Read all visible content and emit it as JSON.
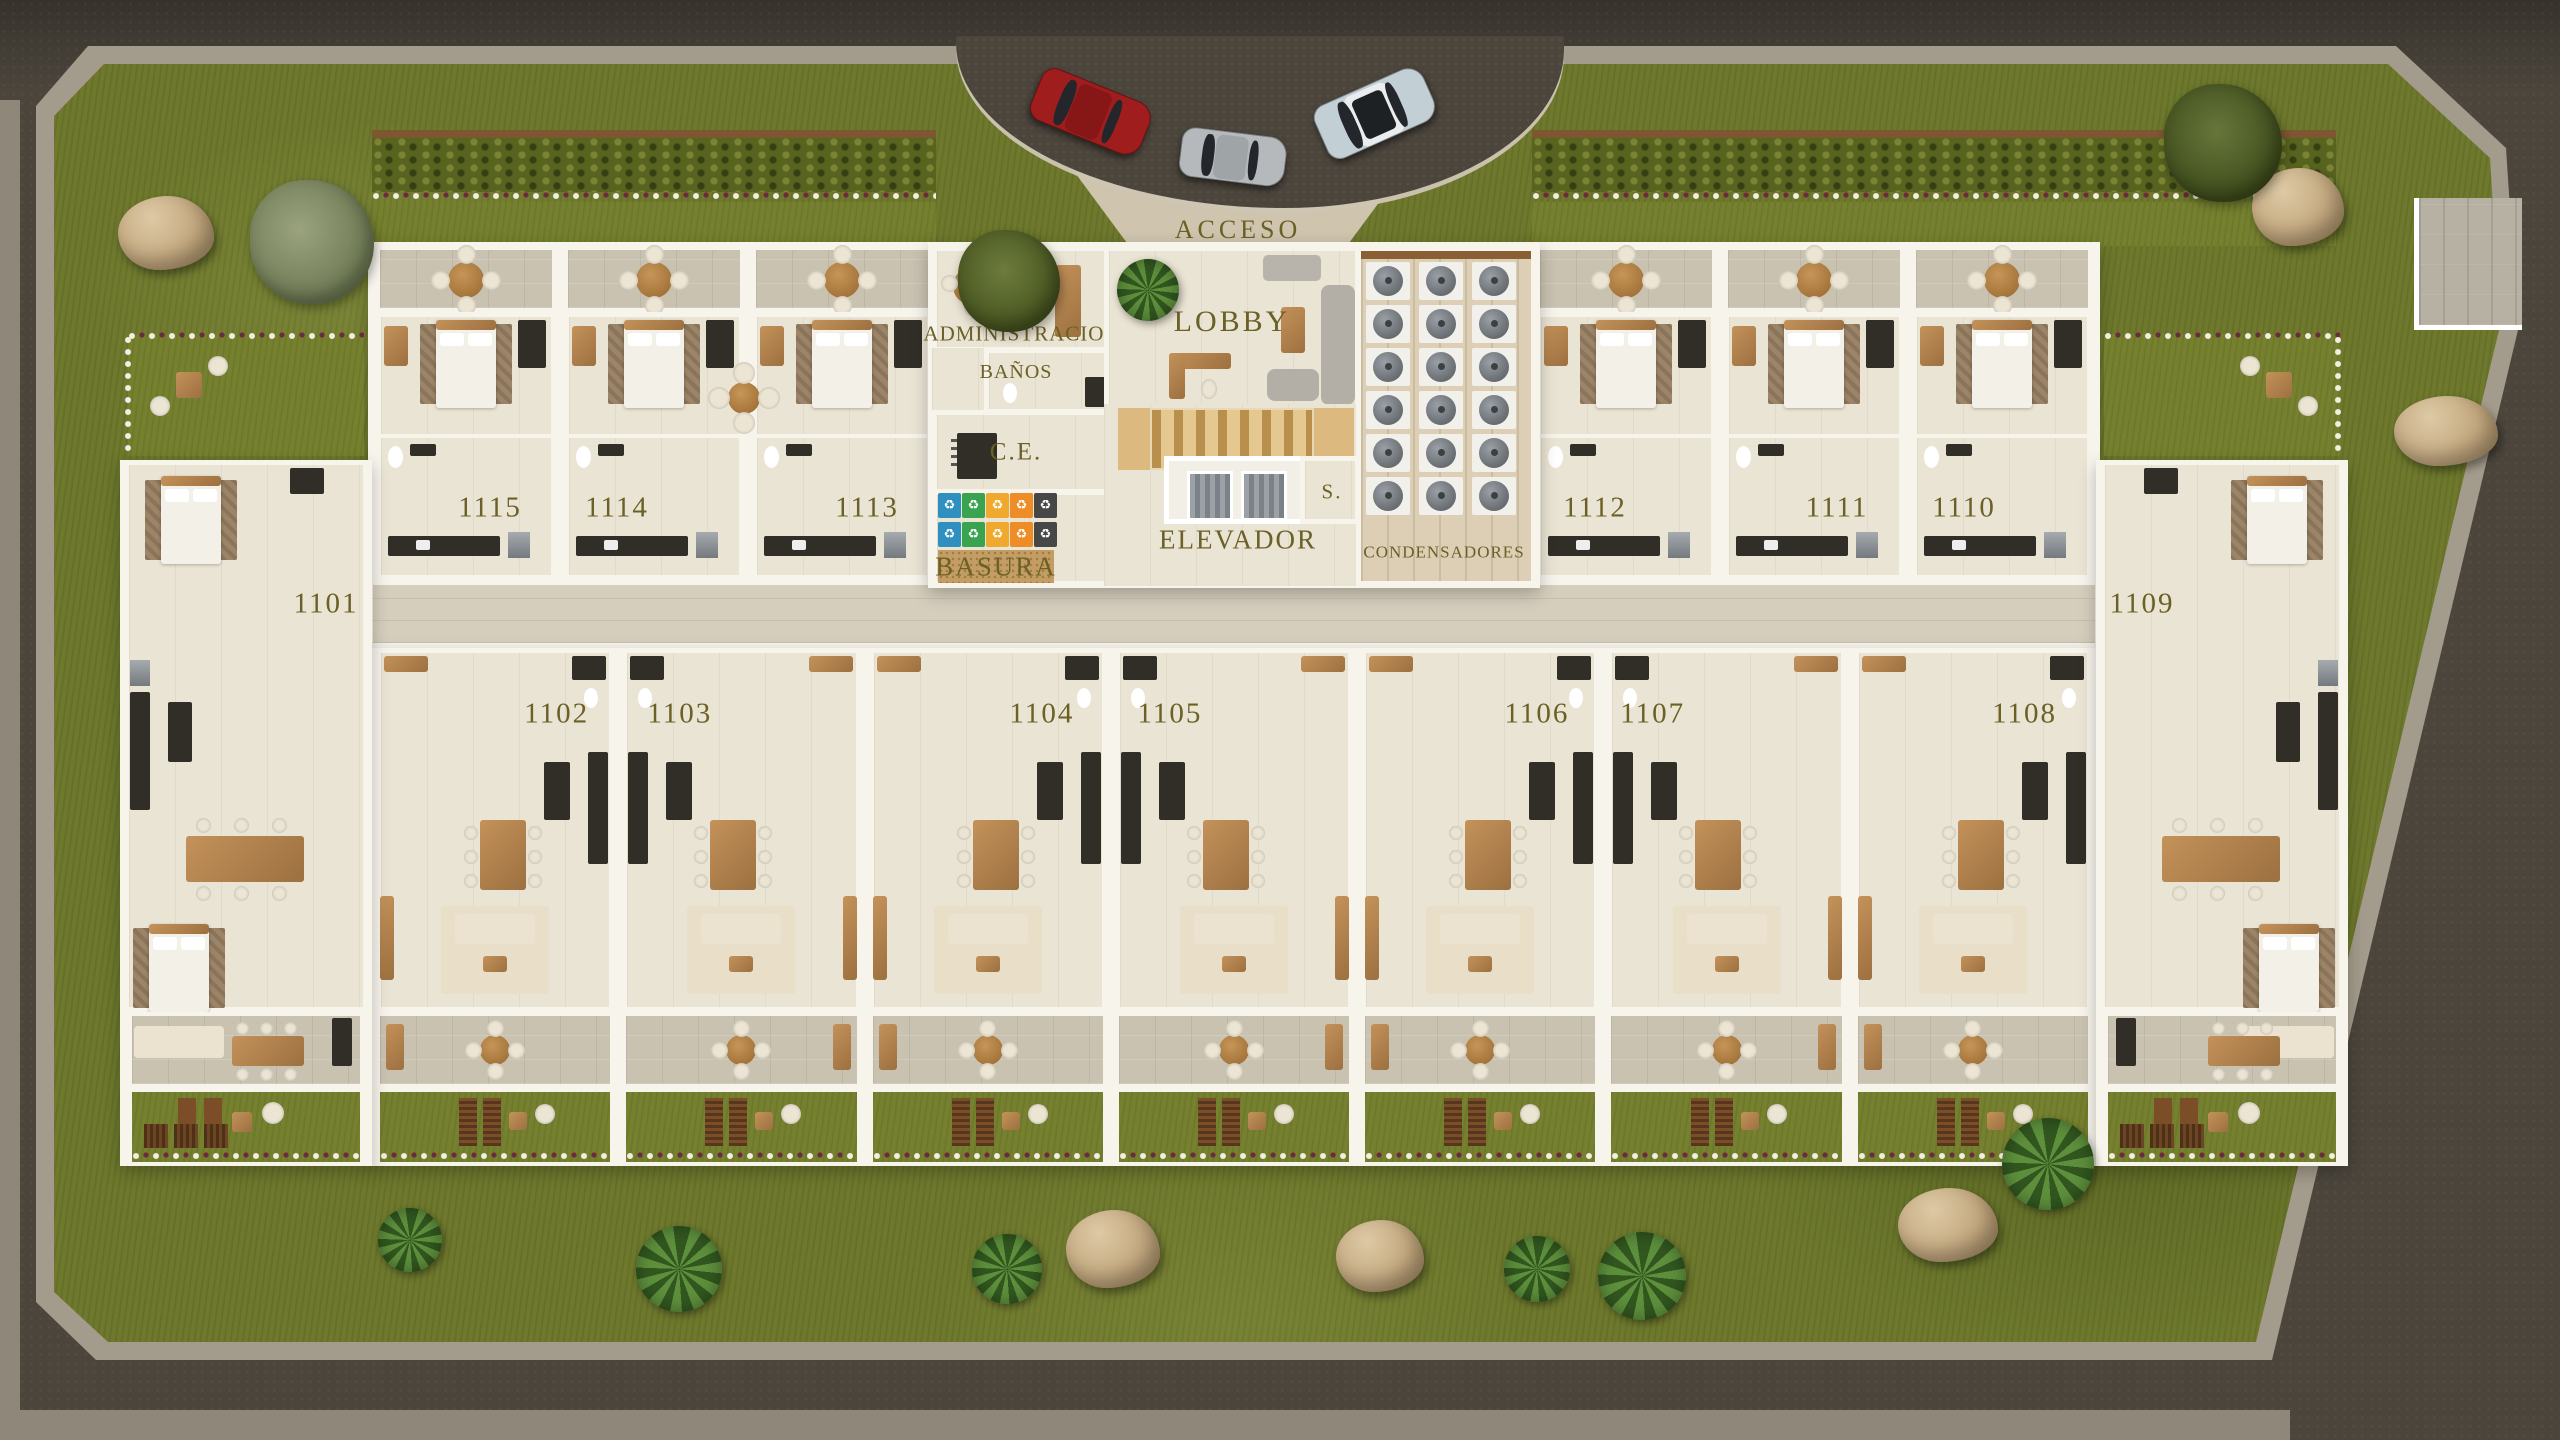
{
  "labels": {
    "acceso": "ACCESO",
    "administracion": "ADMINISTRACION",
    "banos": "BAÑOS",
    "lobby": "LOBBY",
    "ce": "C.E.",
    "elevador": "ELEVADOR",
    "s": "S.",
    "basura": "BASURA",
    "condensadores": "CONDENSADORES"
  },
  "units": {
    "top_left_row": [
      "1115",
      "1114",
      "1113"
    ],
    "top_right_row": [
      "1112",
      "1111",
      "1110"
    ],
    "left_end_unit": "1101",
    "right_end_unit": "1109",
    "bottom_row": [
      "1102",
      "1103",
      "1104",
      "1105",
      "1106",
      "1107",
      "1108"
    ]
  },
  "recycling_bins": {
    "rows": 2,
    "columns": 5,
    "bin_colors": [
      "#2f8fbe",
      "#3aa34f",
      "#f0a92f",
      "#ee8c26",
      "#474747"
    ],
    "icon": "recycle-icon"
  },
  "condensers": {
    "rows": 6,
    "columns": 3
  },
  "cars": [
    {
      "name": "red-suv-car",
      "body": "#a01d1d",
      "roof": "#871616"
    },
    {
      "name": "silver-coupe-car",
      "body": "#b5b9bc",
      "roof": "#9fa4a7"
    },
    {
      "name": "light-blue-suv-car",
      "body": "#c2d0d6",
      "roof": "#e9edee"
    }
  ],
  "palette": {
    "road": "#4b453c",
    "sidewalk": "#a39b8b",
    "grass": "#6e792d",
    "hedge": "#57631f",
    "concrete": "#c9c2b1",
    "floor": "#eae4d4",
    "corridor": "#d5cebd",
    "wall": "#f7f4ec",
    "wood": "#b5834b",
    "ink": "#6b6026"
  }
}
